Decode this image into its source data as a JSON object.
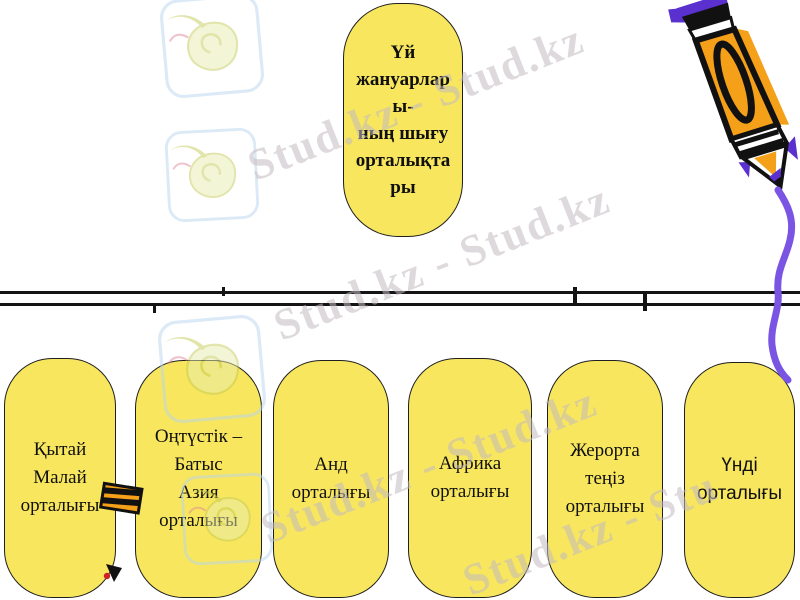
{
  "diagram": {
    "root_box": {
      "lines": [
        "Үй",
        "жануарлар",
        "ы-",
        "ның шығу",
        "орталықта",
        "ры"
      ]
    },
    "centers": [
      {
        "lines": [
          "Қытай",
          "Малай",
          "орталығы"
        ]
      },
      {
        "lines": [
          "Оңтүстік –",
          "Батыс",
          "Азия",
          "орталығы"
        ]
      },
      {
        "lines": [
          "Анд",
          "орталығы"
        ]
      },
      {
        "lines": [
          "Африка",
          "орталығы"
        ]
      },
      {
        "lines": [
          "Жерорта",
          "теңіз",
          "орталығы"
        ]
      },
      {
        "lines": [
          "Үнді",
          "орталығы"
        ]
      }
    ]
  },
  "watermark": {
    "logo_icon": "stud-kz-bird-logo",
    "fragments": [
      {
        "text": "Stud.kz - Stud.kz"
      },
      {
        "text": "Stud.kz - Stud.kz"
      },
      {
        "text": "Stud.kz - Stud.kz"
      },
      {
        "text": "Stud.kz - Stu"
      }
    ]
  },
  "colors": {
    "box-fill": "#f7e65e",
    "box-border": "#1f1f1f",
    "text": "#101010",
    "watermark": "#c4bbc0",
    "pencil-orange": "#f5a019",
    "pencil-purple": "#5a30cf",
    "stroke-purple": "#7a55e3",
    "logo-blue": "#b9d6ee",
    "logo-green": "#e9ecb0",
    "logo-green-dark": "#c5cc5a",
    "logo-red": "#e08898"
  }
}
